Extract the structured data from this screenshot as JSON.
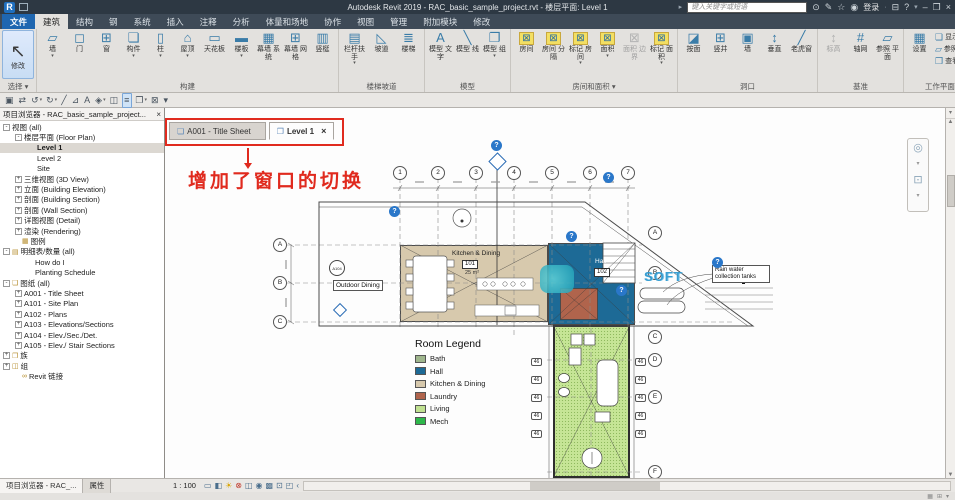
{
  "titlebar": {
    "logo": "R",
    "title": "Autodesk Revit 2019 - RAC_basic_sample_project.rvt - 楼层平面: Level 1",
    "search_placeholder": "键入关键字或短语",
    "signin_label": "登录",
    "help_icon": "?",
    "min_icon": "–",
    "restore_icon": "❐",
    "close_icon": "×"
  },
  "ribbon_tabs": [
    {
      "label": "文件",
      "cls": "file"
    },
    {
      "label": "建筑",
      "cls": "active"
    },
    {
      "label": "结构"
    },
    {
      "label": "钢"
    },
    {
      "label": "系统"
    },
    {
      "label": "插入"
    },
    {
      "label": "注释"
    },
    {
      "label": "分析"
    },
    {
      "label": "体量和场地"
    },
    {
      "label": "协作"
    },
    {
      "label": "视图"
    },
    {
      "label": "管理"
    },
    {
      "label": "附加模块"
    },
    {
      "label": "修改"
    }
  ],
  "ribbon": {
    "groups": [
      {
        "name": "选择 ▾",
        "tools": [
          {
            "label": "修改",
            "glyph": "↖",
            "cls": "big"
          }
        ]
      },
      {
        "name": "构建",
        "tools": [
          {
            "label": "墙",
            "glyph": "▱",
            "cls": "b",
            "arrow": "▾"
          },
          {
            "label": "门",
            "glyph": "◻",
            "cls": "b"
          },
          {
            "label": "窗",
            "glyph": "⊞",
            "cls": "b"
          },
          {
            "label": "构件",
            "glyph": "❏",
            "cls": "b",
            "arrow": "▾"
          },
          {
            "label": "柱",
            "glyph": "▯",
            "cls": "b",
            "arrow": "▾"
          },
          {
            "label": "屋顶",
            "glyph": "⌂",
            "cls": "b",
            "arrow": "▾"
          },
          {
            "label": "天花板",
            "glyph": "▭",
            "cls": "b"
          },
          {
            "label": "楼板",
            "glyph": "▬",
            "cls": "b",
            "arrow": "▾"
          },
          {
            "label": "幕墙 系统",
            "glyph": "▦",
            "cls": "b"
          },
          {
            "label": "幕墙 网格",
            "glyph": "⊞",
            "cls": "b"
          },
          {
            "label": "竖梃",
            "glyph": "▥",
            "cls": "b"
          }
        ]
      },
      {
        "name": "楼梯坡道",
        "tools": [
          {
            "label": "栏杆扶手",
            "glyph": "▤",
            "cls": "b",
            "arrow": "▾"
          },
          {
            "label": "坡道",
            "glyph": "◺",
            "cls": "b"
          },
          {
            "label": "楼梯",
            "glyph": "≣",
            "cls": "b"
          }
        ]
      },
      {
        "name": "模型",
        "tools": [
          {
            "label": "模型 文字",
            "glyph": "A",
            "cls": "b"
          },
          {
            "label": "模型 线",
            "glyph": "╲",
            "cls": "b"
          },
          {
            "label": "模型 组",
            "glyph": "❐",
            "cls": "b",
            "arrow": "▾"
          }
        ]
      },
      {
        "name": "房间和面积 ▾",
        "tools": [
          {
            "label": "房间",
            "glyph": "⊠",
            "cls": "y"
          },
          {
            "label": "房间 分隔",
            "glyph": "⊠",
            "cls": "y"
          },
          {
            "label": "标记 房间",
            "glyph": "⊠",
            "cls": "y",
            "arrow": "▾"
          },
          {
            "label": "面积",
            "glyph": "⊠",
            "cls": "y",
            "arrow": "▾"
          },
          {
            "label": "面积 边界",
            "glyph": "⊠",
            "cls": "g"
          },
          {
            "label": "标记 面积",
            "glyph": "⊠",
            "cls": "y",
            "arrow": "▾"
          }
        ]
      },
      {
        "name": "洞口",
        "tools": [
          {
            "label": "按面",
            "glyph": "◪",
            "cls": "b"
          },
          {
            "label": "竖井",
            "glyph": "⊞",
            "cls": "b"
          },
          {
            "label": "墙",
            "glyph": "▣",
            "cls": "b"
          },
          {
            "label": "垂直",
            "glyph": "↕",
            "cls": "b"
          },
          {
            "label": "老虎窗",
            "glyph": "╱",
            "cls": "b"
          }
        ]
      },
      {
        "name": "基准",
        "tools": [
          {
            "label": "标高",
            "glyph": "↕",
            "cls": "g"
          },
          {
            "label": "轴网",
            "glyph": "#",
            "cls": "b"
          },
          {
            "label": "参照 平面",
            "glyph": "▱",
            "cls": "b"
          }
        ]
      },
      {
        "name": "工作平面",
        "tools": [
          {
            "label": "设置",
            "glyph": "▦",
            "cls": "b"
          }
        ],
        "stack": [
          {
            "label": "显示",
            "glyph": "❏"
          },
          {
            "label": "参照 平面",
            "glyph": "▱"
          },
          {
            "label": "查看器",
            "glyph": "❒"
          }
        ]
      }
    ]
  },
  "qat": {
    "items": [
      {
        "glyph": "▣"
      },
      {
        "glyph": "⇄"
      },
      {
        "glyph": "↺",
        "arrow": "▾"
      },
      {
        "glyph": "↻",
        "arrow": "▾"
      },
      {
        "glyph": "╱"
      },
      {
        "glyph": "⊿"
      },
      {
        "glyph": "A"
      },
      {
        "glyph": "◈",
        "arrow": "▾"
      },
      {
        "glyph": "◫"
      },
      {
        "glyph": "≡",
        "cls": "hl"
      },
      {
        "glyph": "❐",
        "arrow": "▾"
      },
      {
        "glyph": "⊠"
      },
      {
        "glyph": "▾"
      }
    ]
  },
  "browser": {
    "title": "项目浏览器 - RAC_basic_sample_project...",
    "close_icon": "×",
    "items": [
      {
        "exp": "-",
        "label": "视图 (all)",
        "cls": "lv0"
      },
      {
        "exp": "-",
        "label": "楼层平面 (Floor Plan)",
        "cls": "lv1"
      },
      {
        "label": "Level 1",
        "cls": "lv2 sel"
      },
      {
        "label": "Level 2",
        "cls": "lv2"
      },
      {
        "label": "Site",
        "cls": "lv2"
      },
      {
        "exp": "+",
        "label": "三维视图 (3D View)",
        "cls": "lv1"
      },
      {
        "exp": "+",
        "label": "立面 (Building Elevation)",
        "cls": "lv1"
      },
      {
        "exp": "+",
        "label": "剖面 (Building Section)",
        "cls": "lv1"
      },
      {
        "exp": "+",
        "label": "剖面 (Wall Section)",
        "cls": "lv1"
      },
      {
        "exp": "+",
        "label": "详图视图 (Detail)",
        "cls": "lv1"
      },
      {
        "exp": "+",
        "label": "渲染 (Rendering)",
        "cls": "lv1"
      },
      {
        "icon": "▦",
        "label": "图例",
        "cls": "lv0i"
      },
      {
        "exp": "-",
        "icon": "▤",
        "label": "明细表/数量 (all)",
        "cls": "lv0"
      },
      {
        "label": "How do I",
        "cls": "lv1t"
      },
      {
        "label": "Planting Schedule",
        "cls": "lv1t"
      },
      {
        "exp": "-",
        "icon": "❏",
        "label": "图纸 (all)",
        "cls": "lv0"
      },
      {
        "exp": "+",
        "label": "A001 - Title Sheet",
        "cls": "lv1"
      },
      {
        "exp": "+",
        "label": "A101 - Site Plan",
        "cls": "lv1"
      },
      {
        "exp": "+",
        "label": "A102 - Plans",
        "cls": "lv1"
      },
      {
        "exp": "+",
        "label": "A103 - Elevations/Sections",
        "cls": "lv1"
      },
      {
        "exp": "+",
        "label": "A104 - Elev./Sec./Det.",
        "cls": "lv1"
      },
      {
        "exp": "+",
        "label": "A105 - Elev./ Stair Sections",
        "cls": "lv1"
      },
      {
        "exp": "+",
        "icon": "❐",
        "label": "族",
        "cls": "lv0"
      },
      {
        "exp": "+",
        "icon": "◫",
        "label": "组",
        "cls": "lv0"
      },
      {
        "icon": "∞",
        "label": "Revit 链接",
        "cls": "lv0i"
      }
    ]
  },
  "view_tabs": [
    {
      "label": "A001 - Title Sheet",
      "doc": "❏",
      "cls": ""
    },
    {
      "label": "Level 1",
      "doc": "❐",
      "cls": "active",
      "close": "×"
    }
  ],
  "annotation": {
    "text": "增加了窗口的切换",
    "color": "#e02a1e"
  },
  "plan": {
    "help_glyph": "?",
    "column_grids": [
      "1",
      "2",
      "3",
      "4",
      "5",
      "6",
      "7"
    ],
    "row_grids_left": [
      "A",
      "B",
      "C"
    ],
    "row_grids_right": [
      "A",
      "B",
      "C",
      "D",
      "E",
      "F"
    ],
    "rooms": {
      "kitchen": {
        "name": "Kitchen & Dining",
        "tag": "101",
        "area": "25 m²",
        "color": "#d7c9ad"
      },
      "hall": {
        "name": "Hall",
        "tag": "102",
        "color": "#1d6a96"
      },
      "laundry": {
        "name": "Laundry",
        "color": "#b0644c"
      },
      "living": {
        "name": "Living",
        "color": "#c6e596"
      }
    },
    "labels": {
      "outdoor_dining": "Outdoor Dining",
      "rain_note": "Rain water collection tanks",
      "detail_marker": "A104"
    },
    "window_tags_left": [
      "46",
      "46",
      "46",
      "46",
      "46"
    ],
    "window_tags_right": [
      "46",
      "46",
      "46",
      "46",
      "46"
    ],
    "legend": {
      "title": "Room Legend",
      "entries": [
        {
          "name": "Bath",
          "color": "#9fb68d"
        },
        {
          "name": "Hall",
          "color": "#1d6a96"
        },
        {
          "name": "Kitchen & Dining",
          "color": "#d7c9ad"
        },
        {
          "name": "Laundry",
          "color": "#b0644c"
        },
        {
          "name": "Living",
          "color": "#c0e191"
        },
        {
          "name": "Mech",
          "color": "#2eb84b"
        }
      ]
    },
    "watermark": "SOFT"
  },
  "bottom": {
    "browser_tab": "项目浏览器 - RAC_...",
    "properties_tab": "属性",
    "scale": "1 : 100",
    "view_icons": [
      {
        "glyph": "▭"
      },
      {
        "glyph": "◧"
      },
      {
        "glyph": "☀",
        "cls": "sun"
      },
      {
        "glyph": "⊗",
        "cls": "red"
      },
      {
        "glyph": "◫"
      },
      {
        "glyph": "◉"
      },
      {
        "glyph": "▩"
      },
      {
        "glyph": "⊡"
      },
      {
        "glyph": "◰"
      },
      {
        "glyph": "‹"
      }
    ]
  }
}
